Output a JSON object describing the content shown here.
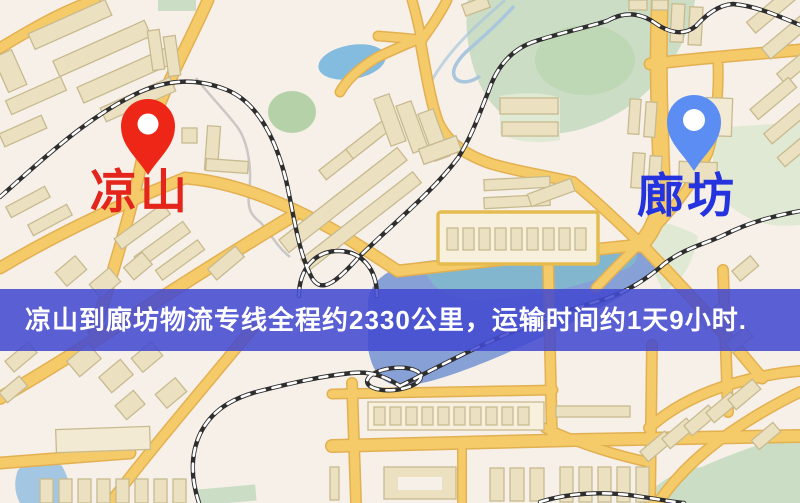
{
  "page": {
    "width": 800,
    "height": 503,
    "kind": "map-route-view"
  },
  "banner": {
    "text": "凉山到廊坊物流专线全程约2330公里，运输时间约1天9小时."
  },
  "route": {
    "origin": "凉山",
    "destination": "廊坊",
    "service": "物流专线",
    "distance_text": "约2330公里",
    "duration_text": "约1天9小时"
  },
  "markers": [
    {
      "id": "origin",
      "label": "凉山",
      "pin_color": "#EE2617",
      "label_color": "#E3251B"
    },
    {
      "id": "destination",
      "label": "廊坊",
      "pin_color": "#5C8DF2",
      "label_color": "#2433DE"
    }
  ],
  "colors": {
    "background": "#F6F0E9",
    "road": "#F4CB68",
    "road_casing": "#E3B051",
    "building": "#EBE1C1",
    "building_light": "#F2EAD3",
    "building_outline": "#C8BA8F",
    "market_fill": "#F7F0DC",
    "market_outline": "#E5BC4F",
    "park": "#CBDEC5",
    "park_dark": "#B5D1A8",
    "park_pale": "#E0E9D4",
    "water": "#7D9AD4",
    "water_teal": "#7FC2CA",
    "lake": "#83BCDE",
    "water_light": "#A3C6E2",
    "railway": "#2E2E2E",
    "stream": "#CCC6C4",
    "river": "#A9C6DC",
    "banner_bg": "rgba(67,73,208,0.87)",
    "banner_text": "#FFFFFF"
  }
}
